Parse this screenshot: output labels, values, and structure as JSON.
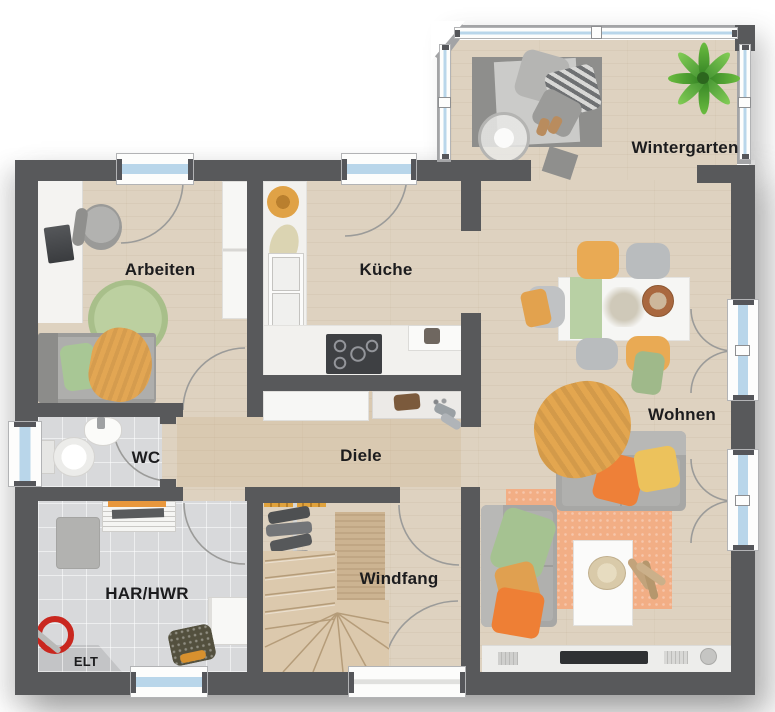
{
  "floorplan": {
    "rooms": [
      {
        "label": "Wintergarten"
      },
      {
        "label": "Arbeiten"
      },
      {
        "label": "Küche"
      },
      {
        "label": "Wohnen"
      },
      {
        "label": "WC"
      },
      {
        "label": "Diele"
      },
      {
        "label": "HAR/HWR"
      },
      {
        "label": "Windfang"
      },
      {
        "label": "ELT"
      }
    ],
    "colors": {
      "wall": "#58595b",
      "wintergarten_frame": "#a3a4a6",
      "window_glass": "#b9d6ea",
      "floor_wood": "#ded2c0",
      "floor_tile": "#d8d9db",
      "stairs_wood": "#dcc9ad",
      "accent_orange": "#ee7f35",
      "accent_mustard": "#e3a64f",
      "accent_green": "#a5c291",
      "rug_orange": "#f2ae85",
      "rug_green": "#b5c998",
      "plant_green": "#5fae3c",
      "label_text": "#1c1c1e"
    }
  }
}
